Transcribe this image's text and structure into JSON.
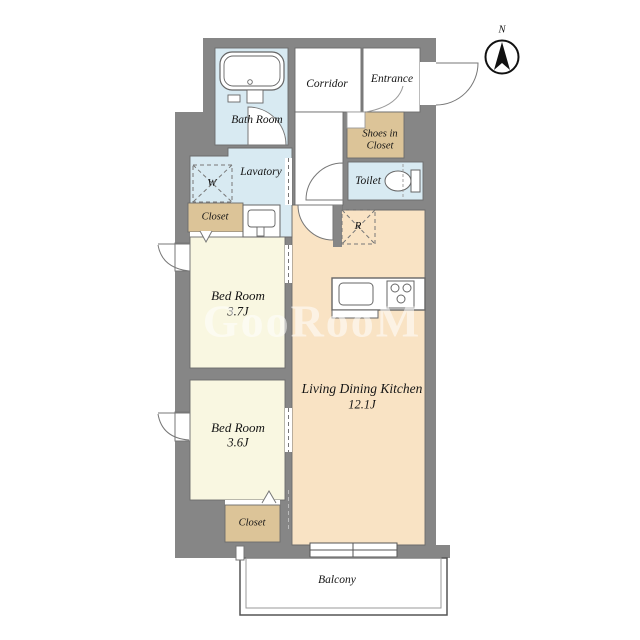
{
  "watermark": {
    "text": "GooRooM"
  },
  "compass": {
    "north": "N"
  },
  "rooms": {
    "bath": {
      "name": "Bath Room"
    },
    "corridor": {
      "name": "Corridor"
    },
    "entrance": {
      "name": "Entrance"
    },
    "shoes_in_closet": {
      "line1": "Shoes in",
      "line2": "Closet"
    },
    "lavatory": {
      "name": "Lavatory"
    },
    "toilet": {
      "name": "Toilet"
    },
    "closet_upper": {
      "name": "Closet"
    },
    "closet_lower": {
      "name": "Closet"
    },
    "bedroom_1": {
      "name": "Bed Room",
      "size": "3.7J"
    },
    "bedroom_2": {
      "name": "Bed Room",
      "size": "3.6J"
    },
    "ldk": {
      "name": "Living Dining Kitchen",
      "size": "12.1J"
    },
    "balcony": {
      "name": "Balcony"
    }
  },
  "fixtures": {
    "washer": "W",
    "fridge": "R"
  },
  "colors": {
    "wall": "#868686",
    "wet_room": "#d8eaf2",
    "closet": "#dcc498",
    "bedroom": "#f9f7e1",
    "ldk": "#f9e3c4",
    "outline": "#6b6b6b"
  }
}
